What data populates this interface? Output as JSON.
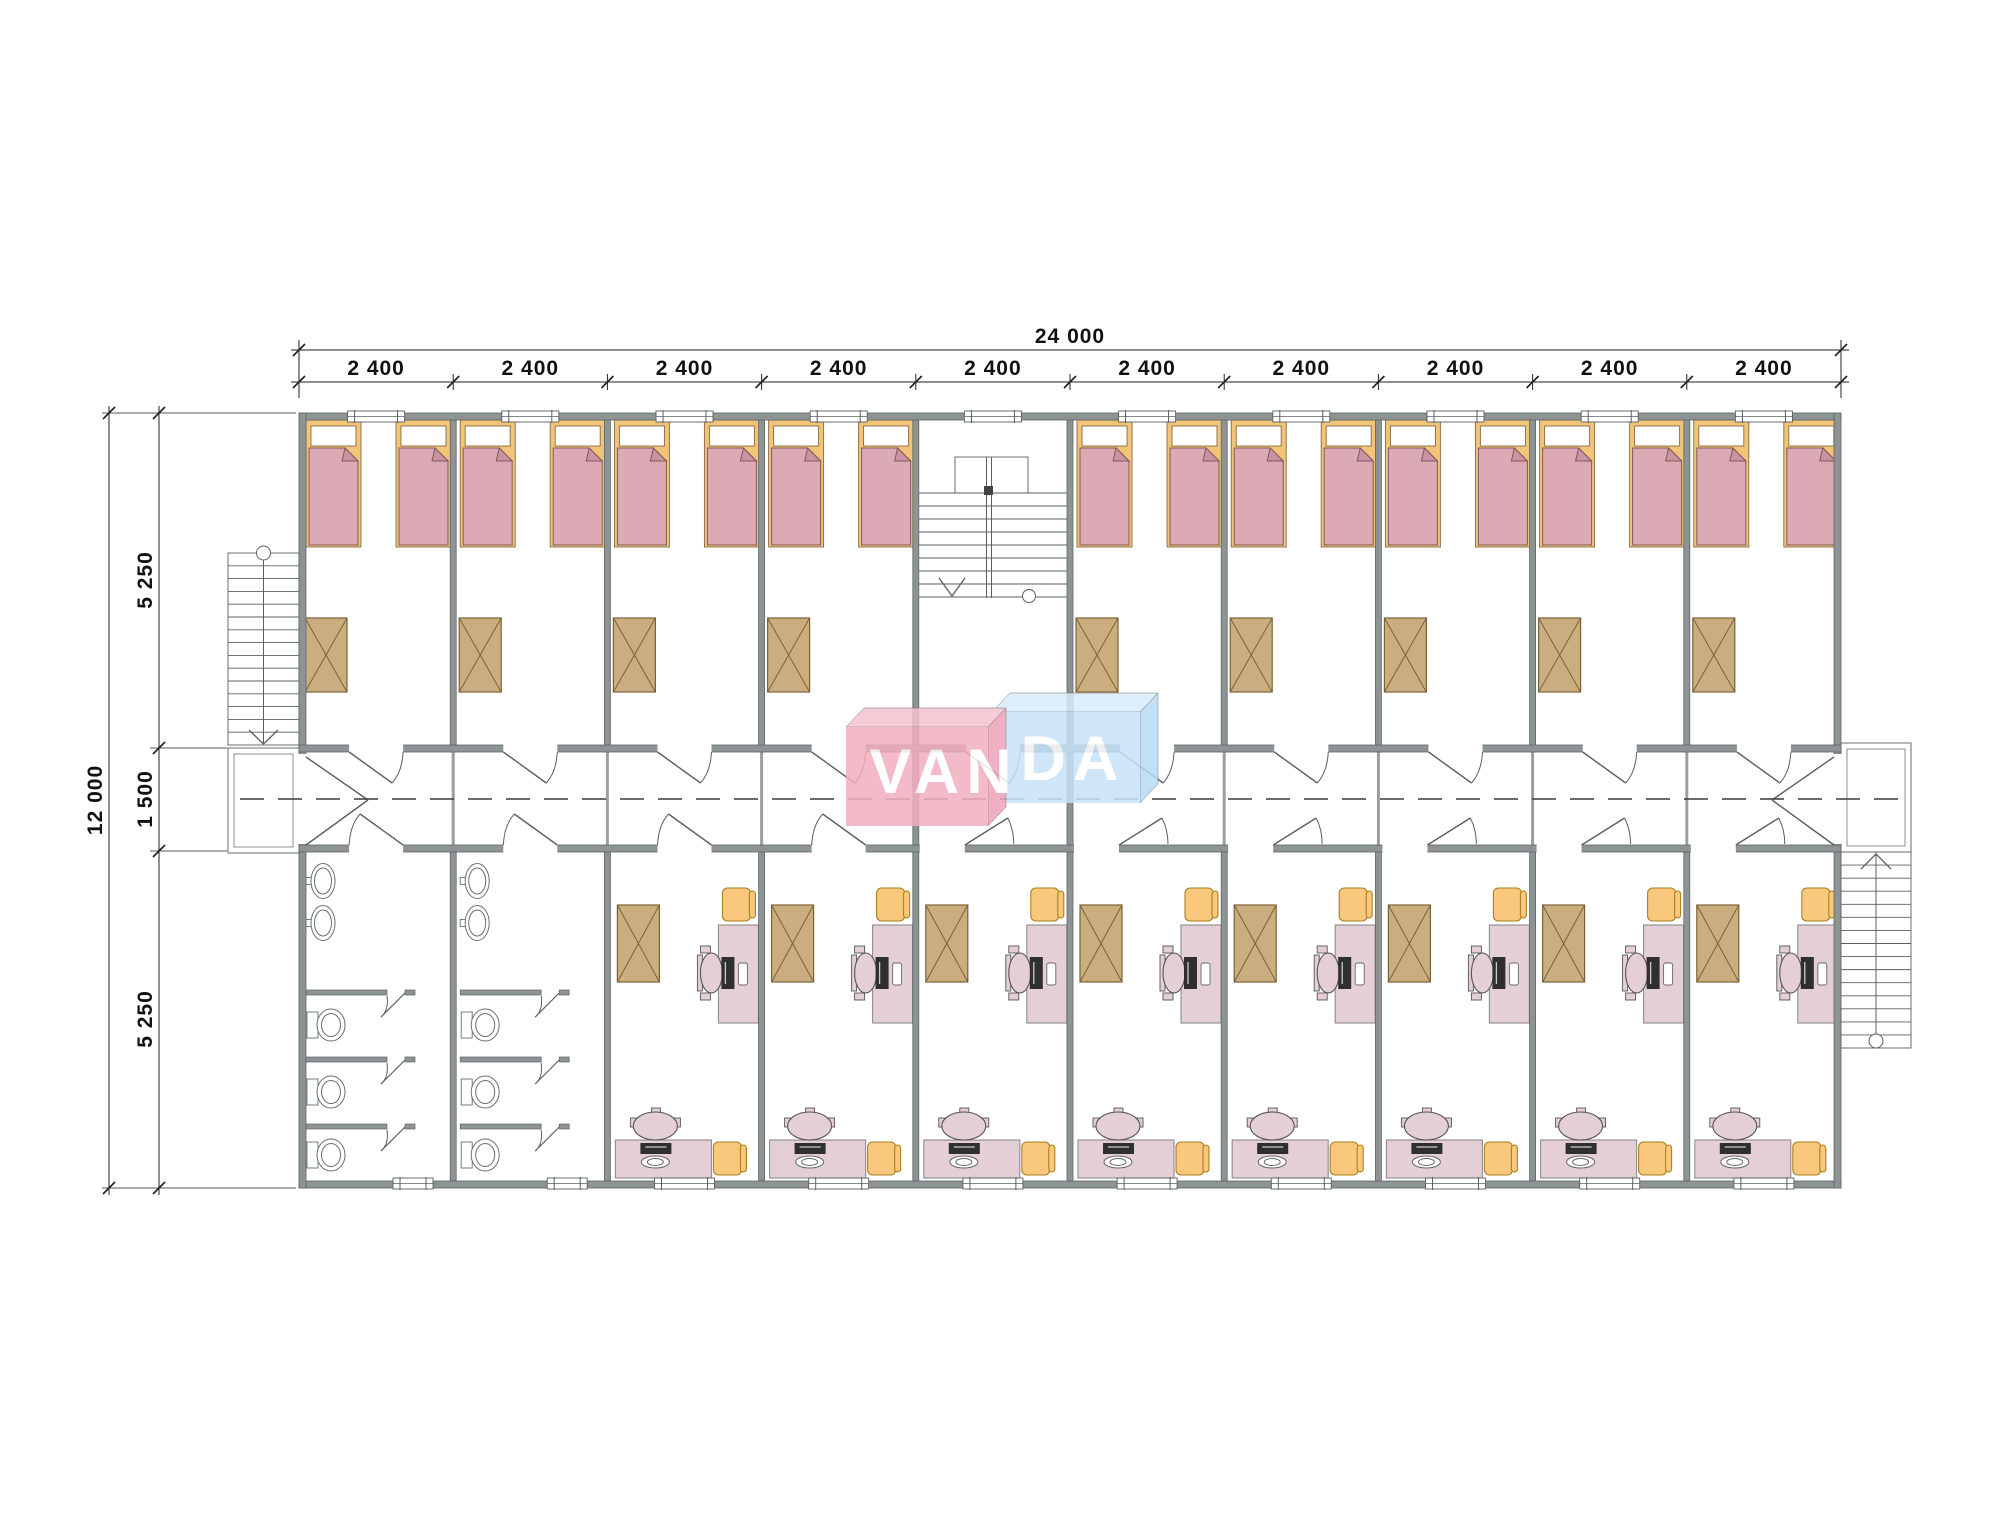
{
  "page": {
    "background": "#ffffff",
    "description": "Architectural floor plan of a modular dormitory building, VANDA watermark"
  },
  "brand": {
    "name": "VANDA",
    "text_left": "VAN",
    "text_right": "DA"
  },
  "dimensions": {
    "top_total": "24 000",
    "top_segment": "2 400",
    "top_segment_count": 10,
    "left_total": "12 000",
    "left_segments": [
      "5 250",
      "1 500",
      "5 250"
    ]
  },
  "building": {
    "modules": 10,
    "bedrooms": 9,
    "beds": 18,
    "wardrobe_tables": 17,
    "study_rooms": 8,
    "desks_per_study_room": 2,
    "bathrooms": 2,
    "sinks_per_bathroom": 2,
    "toilet_stalls_per_bathroom": 3,
    "staircases": 3,
    "corridor": 1
  },
  "colors": {
    "wall": "#8e9394",
    "wall_edge": "#5f6668",
    "joint": "#9aa0a0",
    "line": "#5a6062",
    "dim_line": "#222222",
    "bed_frame": "#f1c478",
    "bed_frame_edge": "#8a6a42",
    "blanket": "#dcaab4",
    "blanket_edge": "#7e5a5a",
    "blanket_fold": "#cb93a2",
    "table": "#cbae80",
    "table_edge": "#7d6136",
    "desk": "#e4cfd6",
    "desk_edge": "#8d8d8d",
    "stool": "#f9c87c",
    "stool_edge": "#a8801f",
    "monitor": "#2f2f2f",
    "fixture": "#ffffff",
    "fixture_edge": "#6a6f70",
    "centerline": "#3a3a3a",
    "logo_pink_front": "#f2aebf",
    "logo_pink_top": "#f6c3d0",
    "logo_pink_side": "#eda3b7",
    "logo_blue_front": "#c6e2f6",
    "logo_blue_top": "#d9ecfa",
    "logo_blue_side": "#b7dbf3",
    "logo_text": "#ffffff"
  }
}
